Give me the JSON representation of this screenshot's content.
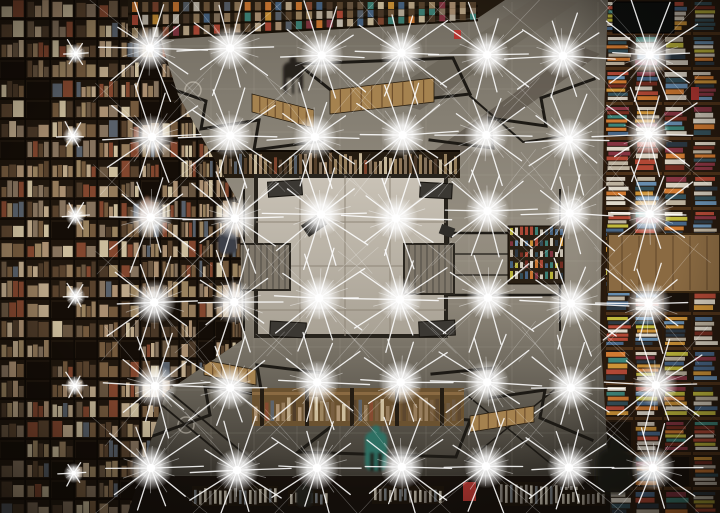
{
  "scene": {
    "alt": "Upward view into a mirrored-ceiling bookstore atrium: floor-to-ceiling bookshelf walls on the left and right, reflected staircases, railings and people, a pale reflected floor at center, and a regular grid of starburst lamps",
    "canvas": {
      "width": 720,
      "height": 513
    },
    "seed": 42,
    "palette": {
      "railing": "#1d1a15",
      "wood": "#a5824f",
      "woodDark": "#6e4f2c",
      "floorLight": "#c9c2b6",
      "floorDark": "#a9a295",
      "floorSeam": "#8f8678",
      "floorEdge": "#27231c",
      "stairFill": "#7f776a",
      "stairLine": "#57524a",
      "leftBase": "#1f160d",
      "leftFrame": "#120b05",
      "rightBase": "#26190e",
      "rightFrame": "#4e3219",
      "shelfLine": "#171007",
      "darkPanel": "#0d0f0e",
      "bottomBand": "#17110b",
      "accentRed": "#b23631",
      "teal": "#2f6f63",
      "seamLine": "rgba(205,198,184,0.16)",
      "glassLine": "#44494a",
      "ray": "#ffffff"
    },
    "leftBookColors": [
      "#9c8262",
      "#b5997a",
      "#7a5f42",
      "#5c4630",
      "#c7b292",
      "#8d7a64",
      "#4e3b2a",
      "#a38b66",
      "#6e5a45",
      "#8a4a32",
      "#5d6672",
      "#d8c9a8"
    ],
    "rightBookColors": [
      "#d6cec0",
      "#c4b9a6",
      "#b84b38",
      "#d79a3a",
      "#49698c",
      "#3e8a7f",
      "#8a3644",
      "#d97f35",
      "#2c3a46",
      "#e0d8c8",
      "#6a93b8",
      "#c9c23f",
      "#7a2e22",
      "#e8e2d4",
      "#35535f"
    ],
    "lights": {
      "bright_cols": [
        152,
        234,
        318,
        400,
        485,
        567,
        652
      ],
      "dim_cols": [
        72
      ],
      "rows": [
        52,
        137,
        215,
        300,
        385,
        470
      ],
      "bright": {
        "core_r": 4.2,
        "glow_r": 11,
        "ray_long": 46,
        "ray_short": 24,
        "rays": 20
      },
      "dim": {
        "core_r": 2.2,
        "glow_r": 5,
        "ray_long": 13,
        "ray_short": 7,
        "rays": 12
      }
    },
    "seams": {
      "vx": [
        168,
        211,
        254,
        297,
        340,
        383,
        426,
        469,
        512,
        555,
        598
      ],
      "hy": [
        46,
        89,
        132,
        175,
        218,
        261,
        304,
        347,
        390,
        433,
        476
      ],
      "x_min": 140,
      "x_max": 608,
      "y_min": 2,
      "y_max": 476
    },
    "beams": [
      {
        "pts": "380,98 420,110 578,2 532,0",
        "fill": "#6e675c",
        "op": 0.95
      },
      {
        "pts": "432,152 452,160 600,54 580,46",
        "fill": "#5f584e",
        "op": 0.8
      }
    ],
    "railings": [
      {
        "d": "M146,80 L206,101 L201,129 L259,120 L254,150 L322,141",
        "w": 3
      },
      {
        "d": "M298,64 L453,58 L470,94 L352,107 Z",
        "w": 3
      },
      {
        "d": "M298,64 L352,107 M453,58 L470,94",
        "w": 1.8
      },
      {
        "d": "M594,79 L541,98 L546,126 L489,118 L493,148 L430,140",
        "w": 3
      },
      {
        "d": "M262,163 L448,159",
        "w": 2
      },
      {
        "d": "M470,96 L523,142 L564,136",
        "w": 2
      },
      {
        "d": "M150,437 L210,415 L205,387 L262,395 L257,365 L322,373",
        "w": 3
      },
      {
        "d": "M298,452 L456,457 L470,420 L350,412 Z",
        "w": 3
      },
      {
        "d": "M298,452 L350,412 M456,457 L470,420",
        "w": 1.8
      },
      {
        "d": "M592,440 L540,418 L545,390 L489,398 L493,368 L432,374",
        "w": 3
      },
      {
        "d": "M448,233 H560 V295 H448 Z",
        "w": 2.5
      },
      {
        "d": "M448,254 H560 M448,275 H560",
        "w": 1.2
      },
      {
        "d": "M152,397 L240,470 M166,389 L254,462",
        "w": 1.8
      },
      {
        "d": "M468,396 L556,468 M554,390 L466,462",
        "w": 1.5
      },
      {
        "d": "M244,190 L244,330 M560,190 L560,330",
        "w": 2
      },
      {
        "d": "M168,196 L168,334",
        "w": 2
      }
    ],
    "stepBlocks": [
      {
        "x": 252,
        "y": 94,
        "w": 62,
        "h": 18,
        "dy": 16,
        "n": 8
      },
      {
        "x": 330,
        "y": 90,
        "w": 104,
        "h": 24,
        "dy": -12,
        "n": 10
      },
      {
        "x": 204,
        "y": 360,
        "w": 52,
        "h": 15,
        "dy": 10,
        "n": 6
      },
      {
        "x": 470,
        "y": 416,
        "w": 64,
        "h": 16,
        "dy": -10,
        "n": 7
      }
    ],
    "floor": {
      "x": 256,
      "y": 176,
      "w": 190,
      "h": 160,
      "seamsX": [
        300,
        345,
        390
      ],
      "seamsY": [
        222,
        266,
        310
      ],
      "cornerSlabs": [
        [
          268,
          181,
          34,
          15,
          -4
        ],
        [
          420,
          183,
          32,
          15,
          3
        ],
        [
          270,
          322,
          36,
          15,
          3
        ],
        [
          419,
          321,
          36,
          15,
          -3
        ]
      ],
      "stairLeft": {
        "x": 238,
        "y": 244,
        "w": 52,
        "h": 46
      },
      "stairRight": {
        "x": 404,
        "y": 244,
        "w": 50,
        "h": 50
      },
      "tables": [
        [
          303,
          218,
          22,
          14,
          -35
        ],
        [
          440,
          226,
          14,
          10,
          20
        ]
      ]
    },
    "aboveFloorBand": {
      "x": 192,
      "y": 150,
      "w": 268,
      "h": 28
    },
    "belowFloorBand": {
      "x": 252,
      "y": 388,
      "w": 212,
      "h": 38
    },
    "bottomStrip": {
      "x": 128,
      "y": 476,
      "w": 482,
      "h": 37
    },
    "tableClusters": [
      {
        "x": 192,
        "y": 486,
        "w": 86,
        "h": 20
      },
      {
        "x": 288,
        "y": 490,
        "w": 40,
        "h": 16
      },
      {
        "x": 372,
        "y": 486,
        "w": 72,
        "h": 18
      },
      {
        "x": 498,
        "y": 482,
        "w": 84,
        "h": 24
      },
      {
        "x": 560,
        "y": 490,
        "w": 46,
        "h": 16
      }
    ],
    "leftWall": {
      "clip": "0,0 148,0 178,95 240,205 242,340 166,392 128,513 0,513",
      "colWidths": [
        26,
        25,
        24,
        23,
        22,
        21,
        20,
        19,
        18,
        17,
        16,
        15
      ],
      "cellH": 20
    },
    "rightWall": {
      "clip": "608,0 720,0 720,513 612,513 600,330 604,120",
      "x0": 604,
      "colWidths": [
        29,
        29,
        29,
        29
      ],
      "cellH": 35
    },
    "woodPanel": {
      "x": 608,
      "y": 234,
      "w": 112,
      "h": 58
    },
    "darkCeilingPanel": {
      "x": 613,
      "y": 2,
      "w": 61,
      "h": 31
    },
    "miniShelf": {
      "x": 508,
      "y": 226,
      "w": 56,
      "h": 58
    },
    "topBand": {
      "poly": "128,0 505,0 478,18 128,42",
      "x0": 132,
      "x1": 478,
      "rows": 3
    },
    "circles": [
      [
        193,
        90,
        8
      ],
      [
        186,
        425,
        8
      ],
      [
        575,
        206,
        7
      ]
    ],
    "accents": [
      [
        463,
        482,
        13,
        19
      ],
      [
        454,
        30,
        7,
        9
      ],
      [
        691,
        87,
        8,
        13
      ]
    ],
    "silhouettes": [
      {
        "x": 283,
        "y": 56,
        "w": 20,
        "h": 38,
        "c": "#26231d",
        "legs": "#8a8478",
        "label": "walking-person-reflection"
      },
      {
        "x": 218,
        "y": 227,
        "w": 19,
        "h": 27,
        "c": "#3c4148",
        "legs": "",
        "label": "browsing-person-reflection"
      },
      {
        "x": 365,
        "y": 425,
        "w": 22,
        "h": 46,
        "c": "#2f6f63",
        "legs": "#23201a",
        "label": "teal-person-reflection"
      },
      {
        "x": 596,
        "y": 436,
        "w": 38,
        "h": 58,
        "c": "#1e1a15",
        "legs": "",
        "blur": 1,
        "label": "blurred-person-reflection"
      },
      {
        "x": 296,
        "y": 481,
        "w": 17,
        "h": 26,
        "c": "#23201b",
        "legs": "",
        "label": "person-reflection-bottom"
      },
      {
        "x": 140,
        "y": 196,
        "w": 14,
        "h": 26,
        "c": "#75503a",
        "legs": "",
        "label": "person-left-gallery"
      }
    ]
  }
}
